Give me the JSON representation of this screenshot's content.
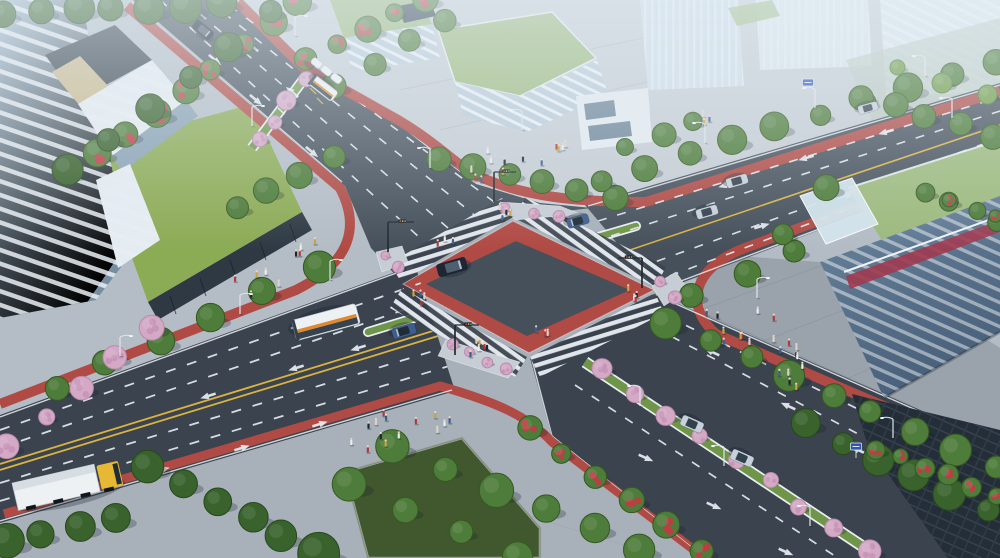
{
  "meta": {
    "type": "architectural-rendering",
    "subject": "aerial-view-of-urban-signalized-intersection",
    "view": "oblique-birds-eye",
    "visible_text": []
  },
  "palette": {
    "asphalt": "#46505b",
    "asphaltDark": "#3a434e",
    "asphaltLight": "#5b6671",
    "redLane": "#b04a44",
    "redBright": "#bb544d",
    "laneWhite": "#e9eef3",
    "laneYellow": "#d9b23f",
    "sidewalk": "#aab3bc",
    "sidewalkLight": "#c6cdd4",
    "sidewalkEast": "#b3bcc4",
    "sidewalkWest": "#b4bdc5",
    "sidewalkSouth": "#a8b1ba",
    "lawn": "#8cab55",
    "lawnDark": "#41582f",
    "roofLawn": "#9cb97c",
    "grassMedian": "#6f9548",
    "glassTower": "#8fa9be",
    "glassDark": "#2e3944",
    "facadeWhite": "#e4ebf1",
    "hazeBuilding": "#cfdde8",
    "slabGlass": "#5e7890",
    "crimson": "#a03a50",
    "darkBuilding": "#242e38",
    "truckYellow": "#e7b833",
    "busOrange": "#e2882d",
    "vehicleWhite": "#eef1f4",
    "vehicleDark": "#1d2733",
    "vehicleSilver": "#c6d0d9",
    "vehicleBlue": "#3f5e8c",
    "poleWhite": "#dfe5ea",
    "signalDark": "#23292f",
    "signBlue": "#2b57b8",
    "shadow": "#16202a"
  },
  "scene": {
    "intersection": {
      "center_surface": "dark-asphalt",
      "border_surface": "red-paving-band",
      "crosswalks": 4,
      "flower_islands": 4,
      "cycle_lane_color": "redLane"
    },
    "roads": [
      {
        "name": "northeast-approach",
        "features": [
          "bus-stop-shelter",
          "blossom-median",
          "white-dashes"
        ]
      },
      {
        "name": "northwest-approach",
        "features": [
          "yellow-center-line",
          "turn-median",
          "white-dashes"
        ]
      },
      {
        "name": "southwest-approach",
        "features": [
          "double-yellow-line",
          "turn-median",
          "truck",
          "bus"
        ]
      },
      {
        "name": "southeast-approach",
        "features": [
          "blossom-median",
          "white-dashes",
          "lane-arrows"
        ]
      }
    ],
    "buildings": [
      {
        "name": "glass-tower-left"
      },
      {
        "name": "office-complex-top-green-roofs"
      },
      {
        "name": "white-corner-building-top"
      },
      {
        "name": "hazy-towers-top-right"
      },
      {
        "name": "red-striped-slab-right-green-roof"
      },
      {
        "name": "dark-glass-building-bottom-right"
      }
    ],
    "vegetation": {
      "kinds": {
        "green": {
          "fill": "#4e7c3a",
          "stroke": "#35591f"
        },
        "dark": {
          "fill": "#39622c",
          "stroke": "#27491d"
        },
        "light": {
          "fill": "#6f9b48",
          "stroke": "#4e7c31"
        },
        "pink": {
          "fill": "#d4a9c6",
          "stroke": "#b98aad",
          "dots": "#c793b6"
        },
        "red": {
          "fill": "#4e7c3a",
          "stroke": "#35591f",
          "dots": "#c23b45"
        }
      },
      "rows": [
        {
          "name": "ne-west-flower-row",
          "kind": "red",
          "from": [
            95,
            155
          ],
          "to": [
            300,
            2
          ],
          "n": 8,
          "r": 12
        },
        {
          "name": "ne-west-green-row",
          "kind": "dark",
          "from": [
            68,
            170
          ],
          "to": [
            268,
            14
          ],
          "n": 6,
          "r": 13
        },
        {
          "name": "top-left-tree-band",
          "kind": "dark",
          "from": [
            5,
            14
          ],
          "to": [
            222,
            4
          ],
          "n": 7,
          "r": 13
        },
        {
          "name": "ne-east-flower-row",
          "kind": "red",
          "from": [
            306,
            60
          ],
          "to": [
            424,
            0
          ],
          "n": 5,
          "r": 11
        },
        {
          "name": "ne-east-green-row",
          "kind": "green",
          "from": [
            336,
            88
          ],
          "to": [
            446,
            20
          ],
          "n": 4,
          "r": 11
        },
        {
          "name": "north-plaza-tree-row",
          "kind": "green",
          "from": [
            440,
            158
          ],
          "to": [
            614,
            196
          ],
          "n": 6,
          "r": 12
        },
        {
          "name": "north-plaza-east-trees",
          "kind": "green",
          "from": [
            628,
            148
          ],
          "to": [
            694,
            122
          ],
          "n": 3,
          "r": 10
        },
        {
          "name": "ne-median-blossom-row",
          "kind": "pink",
          "from": [
            258,
            140
          ],
          "to": [
            304,
            80
          ],
          "n": 4,
          "r": 8
        },
        {
          "name": "west-lawn-edge-trees",
          "kind": "green",
          "from": [
            235,
            206
          ],
          "to": [
            334,
            158
          ],
          "n": 4,
          "r": 12
        },
        {
          "name": "sw-north-sidewalk-trees",
          "kind": "green",
          "from": [
            55,
            386
          ],
          "to": [
            318,
            268
          ],
          "n": 6,
          "r": 13
        },
        {
          "name": "sw-north-blossom-overhang",
          "kind": "pink",
          "from": [
            8,
            446
          ],
          "to": [
            152,
            330
          ],
          "n": 5,
          "r": 10
        },
        {
          "name": "sw-south-tree-canopy",
          "kind": "dark",
          "from": [
            148,
            468
          ],
          "to": [
            318,
            552
          ],
          "n": 6,
          "r": 17
        },
        {
          "name": "corner-tree-canopy",
          "kind": "dark",
          "from": [
            5,
            543
          ],
          "to": [
            118,
            516
          ],
          "n": 4,
          "r": 15
        },
        {
          "name": "south-plaza-tree-row-a",
          "kind": "green",
          "from": [
            395,
            448
          ],
          "to": [
            642,
            550
          ],
          "n": 6,
          "r": 14
        },
        {
          "name": "south-plaza-tree-row-b",
          "kind": "green",
          "from": [
            346,
            486
          ],
          "to": [
            520,
            556
          ],
          "n": 4,
          "r": 14
        },
        {
          "name": "se-cycleway-flower-row",
          "kind": "red",
          "from": [
            530,
            428
          ],
          "to": [
            700,
            550
          ],
          "n": 6,
          "r": 11
        },
        {
          "name": "se-median-blossom-row",
          "kind": "pink",
          "from": [
            600,
            370
          ],
          "to": [
            868,
            550
          ],
          "n": 9,
          "r": 9
        },
        {
          "name": "se-east-tree-row",
          "kind": "green",
          "from": [
            668,
            322
          ],
          "to": [
            996,
            468
          ],
          "n": 9,
          "r": 13
        },
        {
          "name": "nw-north-tree-row",
          "kind": "green",
          "from": [
            602,
            180
          ],
          "to": [
            995,
            62
          ],
          "n": 10,
          "r": 12
        },
        {
          "name": "east-plaza-tree-row",
          "kind": "green",
          "from": [
            694,
            296
          ],
          "to": [
            796,
            252
          ],
          "n": 3,
          "r": 11
        },
        {
          "name": "right-building-trees",
          "kind": "green",
          "from": [
            780,
            232
          ],
          "to": [
            824,
            186
          ],
          "n": 2,
          "r": 11
        },
        {
          "name": "se-building-front-trees",
          "kind": "dark",
          "from": [
            806,
            424
          ],
          "to": [
            988,
            512
          ],
          "n": 6,
          "r": 13
        },
        {
          "name": "se-flower-hedge",
          "kind": "red",
          "from": [
            874,
            448
          ],
          "to": [
            996,
            496
          ],
          "n": 6,
          "r": 9
        },
        {
          "name": "right-edge-hedge",
          "kind": "green",
          "from": [
            928,
            192
          ],
          "to": [
            998,
            222
          ],
          "n": 4,
          "r": 9
        },
        {
          "name": "right-edge-flowers",
          "kind": "red",
          "from": [
            950,
            200
          ],
          "to": [
            992,
            216
          ],
          "n": 2,
          "r": 6
        },
        {
          "name": "right-garden-trees",
          "kind": "green",
          "from": [
            860,
            96
          ],
          "to": [
            990,
            136
          ],
          "n": 5,
          "r": 11
        },
        {
          "name": "right-garden-trees-b",
          "kind": "light",
          "from": [
            900,
            66
          ],
          "to": [
            988,
            96
          ],
          "n": 3,
          "r": 9
        },
        {
          "name": "island-north-flowers",
          "kind": "pink",
          "from": [
            505,
            208
          ],
          "to": [
            556,
            215
          ],
          "n": 3,
          "r": 6
        },
        {
          "name": "island-west-flowers",
          "kind": "pink",
          "from": [
            382,
            255
          ],
          "to": [
            400,
            265
          ],
          "n": 2,
          "r": 5
        },
        {
          "name": "island-east-flowers",
          "kind": "pink",
          "from": [
            658,
            284
          ],
          "to": [
            676,
            296
          ],
          "n": 2,
          "r": 6
        },
        {
          "name": "island-south-flowers",
          "kind": "pink",
          "from": [
            452,
            346
          ],
          "to": [
            505,
            368
          ],
          "n": 4,
          "r": 6
        }
      ]
    },
    "pedestrians": {
      "colors": [
        "#1d2733",
        "#e8eced",
        "#b03a3a",
        "#3f5e8c",
        "#d9d2c8",
        "#caa43a"
      ],
      "clusters": [
        {
          "x": 500,
          "y": 170,
          "n": 8,
          "s": 34
        },
        {
          "x": 556,
          "y": 158,
          "n": 5,
          "s": 22
        },
        {
          "x": 738,
          "y": 330,
          "n": 10,
          "s": 42
        },
        {
          "x": 798,
          "y": 378,
          "n": 5,
          "s": 22
        },
        {
          "x": 255,
          "y": 285,
          "n": 5,
          "s": 24
        },
        {
          "x": 305,
          "y": 250,
          "n": 4,
          "s": 16
        },
        {
          "x": 388,
          "y": 438,
          "n": 9,
          "s": 40
        },
        {
          "x": 432,
          "y": 424,
          "n": 5,
          "s": 18
        },
        {
          "x": 420,
          "y": 300,
          "n": 4,
          "s": 12
        },
        {
          "x": 506,
          "y": 213,
          "n": 4,
          "s": 14
        },
        {
          "x": 476,
          "y": 352,
          "n": 6,
          "s": 16
        },
        {
          "x": 633,
          "y": 297,
          "n": 4,
          "s": 12
        },
        {
          "x": 790,
          "y": 352,
          "n": 5,
          "s": 18
        },
        {
          "x": 446,
          "y": 246,
          "n": 3,
          "s": 10
        },
        {
          "x": 545,
          "y": 332,
          "n": 3,
          "s": 10
        },
        {
          "x": 705,
          "y": 120,
          "n": 3,
          "s": 12
        }
      ]
    },
    "vehicles": [
      {
        "name": "sedan-center",
        "kind": "sedan",
        "color": "vehicleDark",
        "glass": "#4e606f",
        "x": 452,
        "y": 267,
        "rot": -16,
        "len": 30,
        "wid": 13
      },
      {
        "name": "bus-west",
        "kind": "bus",
        "x": 326,
        "y": 322,
        "rot": 165,
        "len": 66,
        "wid": 21
      },
      {
        "name": "bus-north",
        "kind": "bus",
        "x": 323,
        "y": 88,
        "rot": 218,
        "len": 30,
        "wid": 12
      },
      {
        "name": "car-west",
        "kind": "sedan",
        "color": "vehicleBlue",
        "glass": "#1f2b36",
        "x": 404,
        "y": 331,
        "rot": 164,
        "len": 24,
        "wid": 11
      },
      {
        "name": "car-ne",
        "kind": "sedan",
        "color": "vehicleDark",
        "glass": "#44545f",
        "x": 203,
        "y": 30,
        "rot": 40,
        "len": 22,
        "wid": 10
      },
      {
        "name": "car-nw-1",
        "kind": "sedan",
        "color": "vehicleBlue",
        "glass": "#1f2b36",
        "x": 578,
        "y": 221,
        "rot": 164,
        "len": 22,
        "wid": 10
      },
      {
        "name": "car-nw-2",
        "kind": "sedan",
        "color": "vehicleSilver",
        "glass": "#33414d",
        "x": 737,
        "y": 181,
        "rot": 164,
        "len": 22,
        "wid": 10
      },
      {
        "name": "car-nw-3",
        "kind": "sedan",
        "color": "vehicleSilver",
        "glass": "#33414d",
        "x": 707,
        "y": 212,
        "rot": 164,
        "len": 22,
        "wid": 10
      },
      {
        "name": "car-nw-far",
        "kind": "sedan",
        "color": "vehicleSilver",
        "glass": "#33414d",
        "x": 868,
        "y": 108,
        "rot": 164,
        "len": 20,
        "wid": 9
      },
      {
        "name": "car-se-1",
        "kind": "sedan",
        "color": "vehicleSilver",
        "glass": "#33414d",
        "x": 692,
        "y": 424,
        "rot": 204,
        "len": 23,
        "wid": 11
      },
      {
        "name": "car-se-2",
        "kind": "sedan",
        "color": "vehicleSilver",
        "glass": "#33414d",
        "x": 742,
        "y": 458,
        "rot": 204,
        "len": 23,
        "wid": 11
      },
      {
        "name": "truck-yellow",
        "kind": "truck",
        "x": 62,
        "y": 486,
        "rot": -13
      }
    ],
    "road_markings": {
      "arrow_color": "laneWhite",
      "arrows": {
        "ne": [
          {
            "x": 215,
            "y": 60,
            "rot": 130
          },
          {
            "x": 256,
            "y": 100,
            "rot": 130
          },
          {
            "x": 312,
            "y": 152,
            "rot": 130
          },
          {
            "x": 252,
            "y": 46,
            "rot": 310
          },
          {
            "x": 292,
            "y": 92,
            "rot": 310
          }
        ],
        "nw": [
          {
            "x": 726,
            "y": 185,
            "rot": 254
          },
          {
            "x": 806,
            "y": 158,
            "rot": 254
          },
          {
            "x": 886,
            "y": 132,
            "rot": 254
          },
          {
            "x": 762,
            "y": 226,
            "rot": 74
          },
          {
            "x": 846,
            "y": 196,
            "rot": 74
          },
          {
            "x": 926,
            "y": 170,
            "rot": 74
          }
        ],
        "sw": [
          {
            "x": 162,
            "y": 470,
            "rot": 73
          },
          {
            "x": 242,
            "y": 448,
            "rot": 73
          },
          {
            "x": 320,
            "y": 424,
            "rot": 73
          },
          {
            "x": 208,
            "y": 396,
            "rot": 253
          },
          {
            "x": 296,
            "y": 368,
            "rot": 253
          },
          {
            "x": 358,
            "y": 348,
            "rot": 253
          }
        ],
        "se": [
          {
            "x": 712,
            "y": 352,
            "rot": 294
          },
          {
            "x": 788,
            "y": 406,
            "rot": 294
          },
          {
            "x": 858,
            "y": 450,
            "rot": 294
          },
          {
            "x": 926,
            "y": 496,
            "rot": 294
          },
          {
            "x": 646,
            "y": 458,
            "rot": 114
          },
          {
            "x": 714,
            "y": 506,
            "rot": 114
          },
          {
            "x": 786,
            "y": 552,
            "rot": 114
          }
        ]
      }
    },
    "furniture": {
      "streetlights": [
        {
          "x": 295,
          "y": 36,
          "d": 1
        },
        {
          "x": 252,
          "y": 126,
          "d": 1
        },
        {
          "x": 430,
          "y": 168,
          "d": -1
        },
        {
          "x": 522,
          "y": 130,
          "d": -1
        },
        {
          "x": 705,
          "y": 143,
          "d": -1
        },
        {
          "x": 815,
          "y": 108,
          "d": -1
        },
        {
          "x": 925,
          "y": 76,
          "d": -1
        },
        {
          "x": 120,
          "y": 356,
          "d": 1
        },
        {
          "x": 240,
          "y": 314,
          "d": 1
        },
        {
          "x": 330,
          "y": 280,
          "d": 1
        },
        {
          "x": 640,
          "y": 406,
          "d": -1
        },
        {
          "x": 724,
          "y": 466,
          "d": -1
        },
        {
          "x": 810,
          "y": 526,
          "d": -1
        },
        {
          "x": 893,
          "y": 438,
          "d": -1
        },
        {
          "x": 757,
          "y": 298,
          "d": 1
        },
        {
          "x": 952,
          "y": 118,
          "d": -1
        }
      ],
      "traffic_signals": [
        {
          "x": 388,
          "y": 252,
          "ax": 26
        },
        {
          "x": 494,
          "y": 202,
          "ax": 22
        },
        {
          "x": 642,
          "y": 288,
          "ax": -24
        },
        {
          "x": 455,
          "y": 355,
          "ax": 24
        }
      ],
      "blue_signs": [
        {
          "x": 808,
          "y": 94
        },
        {
          "x": 856,
          "y": 458
        }
      ],
      "bus_shelter": {
        "x": 312,
        "y": 60,
        "rot": 38,
        "canopies": 3
      }
    }
  }
}
